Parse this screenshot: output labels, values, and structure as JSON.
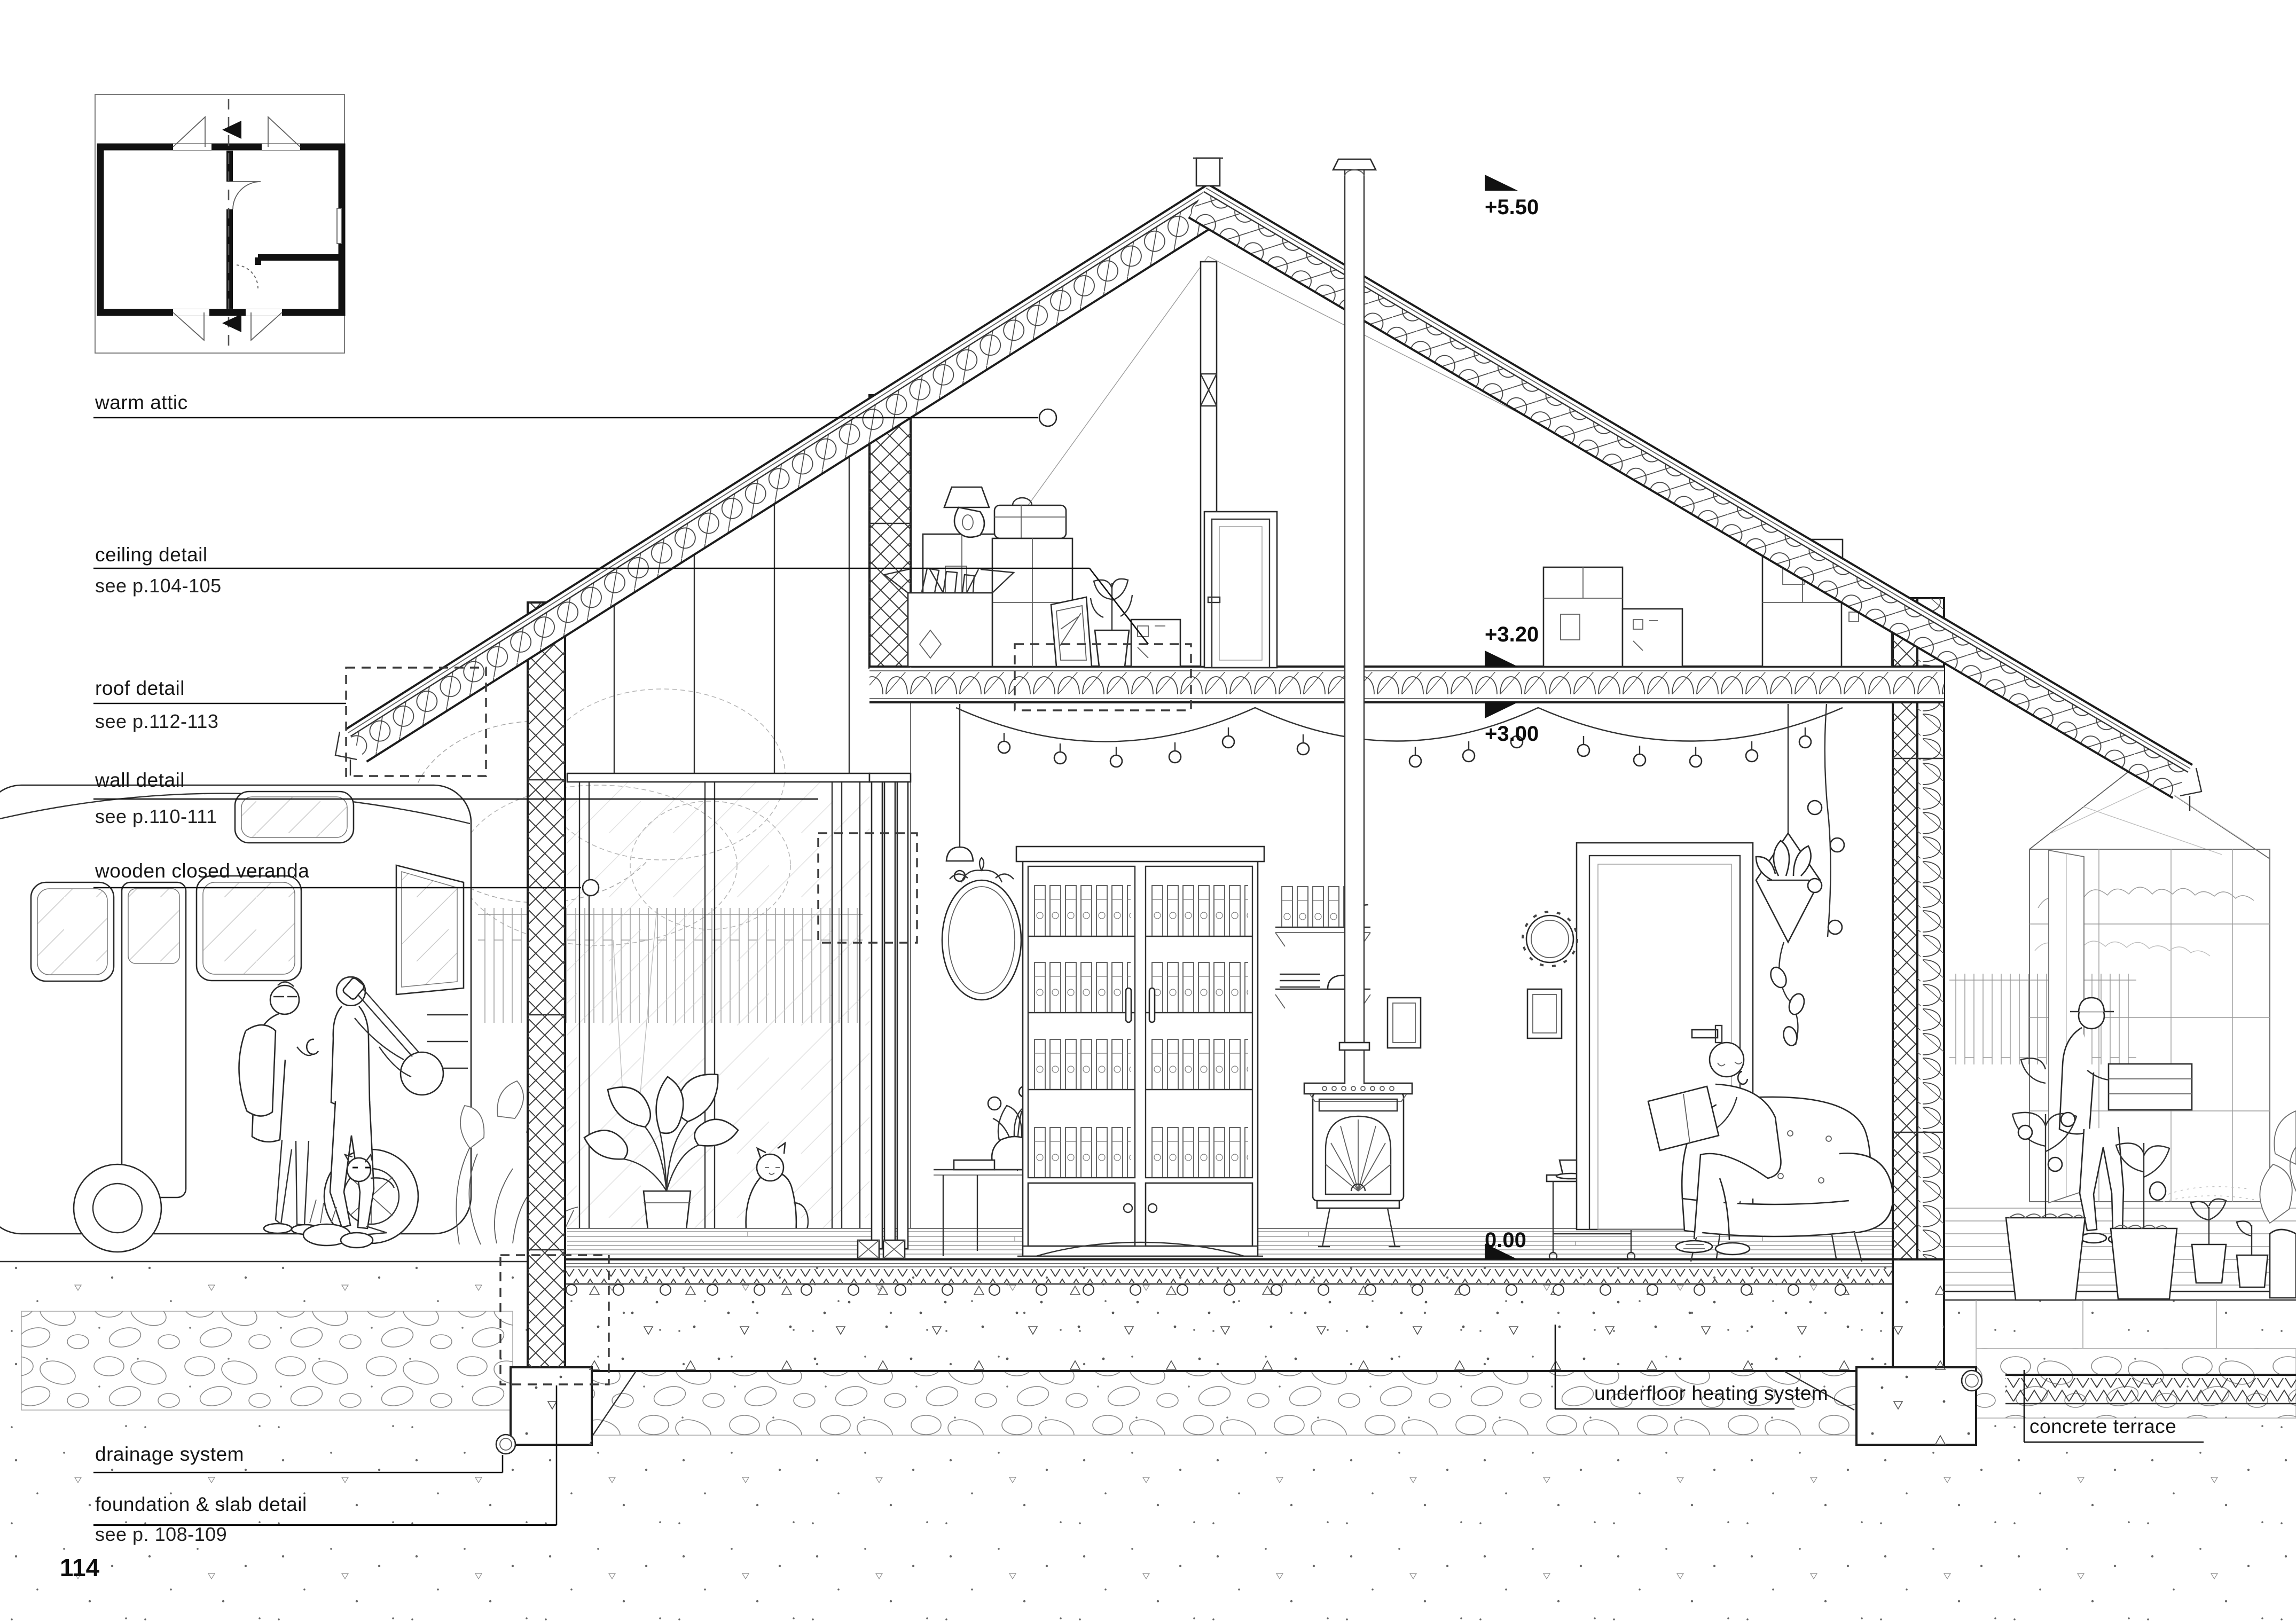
{
  "page": {
    "number": "114"
  },
  "labels": {
    "warm_attic": "warm attic",
    "ceiling_detail": "ceiling detail",
    "ceiling_ref": "see p.104-105",
    "roof_detail": "roof detail",
    "roof_ref": "see p.112-113",
    "wall_detail": "wall detail",
    "wall_ref": "see p.110-111",
    "veranda": "wooden closed veranda",
    "drainage": "drainage system",
    "foundation": "foundation & slab detail",
    "foundation_ref": "see p. 108-109",
    "underfloor": "underfloor heating system",
    "terrace": "concrete terrace"
  },
  "elevations": {
    "ridge": "+5.50",
    "attic_floor": "+3.20",
    "ceiling": "+3.00",
    "floor": "0.00"
  },
  "colors": {
    "ink": "#1a1a1a",
    "mid": "#555555",
    "faint": "#9a9a9a",
    "paper": "#ffffff"
  }
}
